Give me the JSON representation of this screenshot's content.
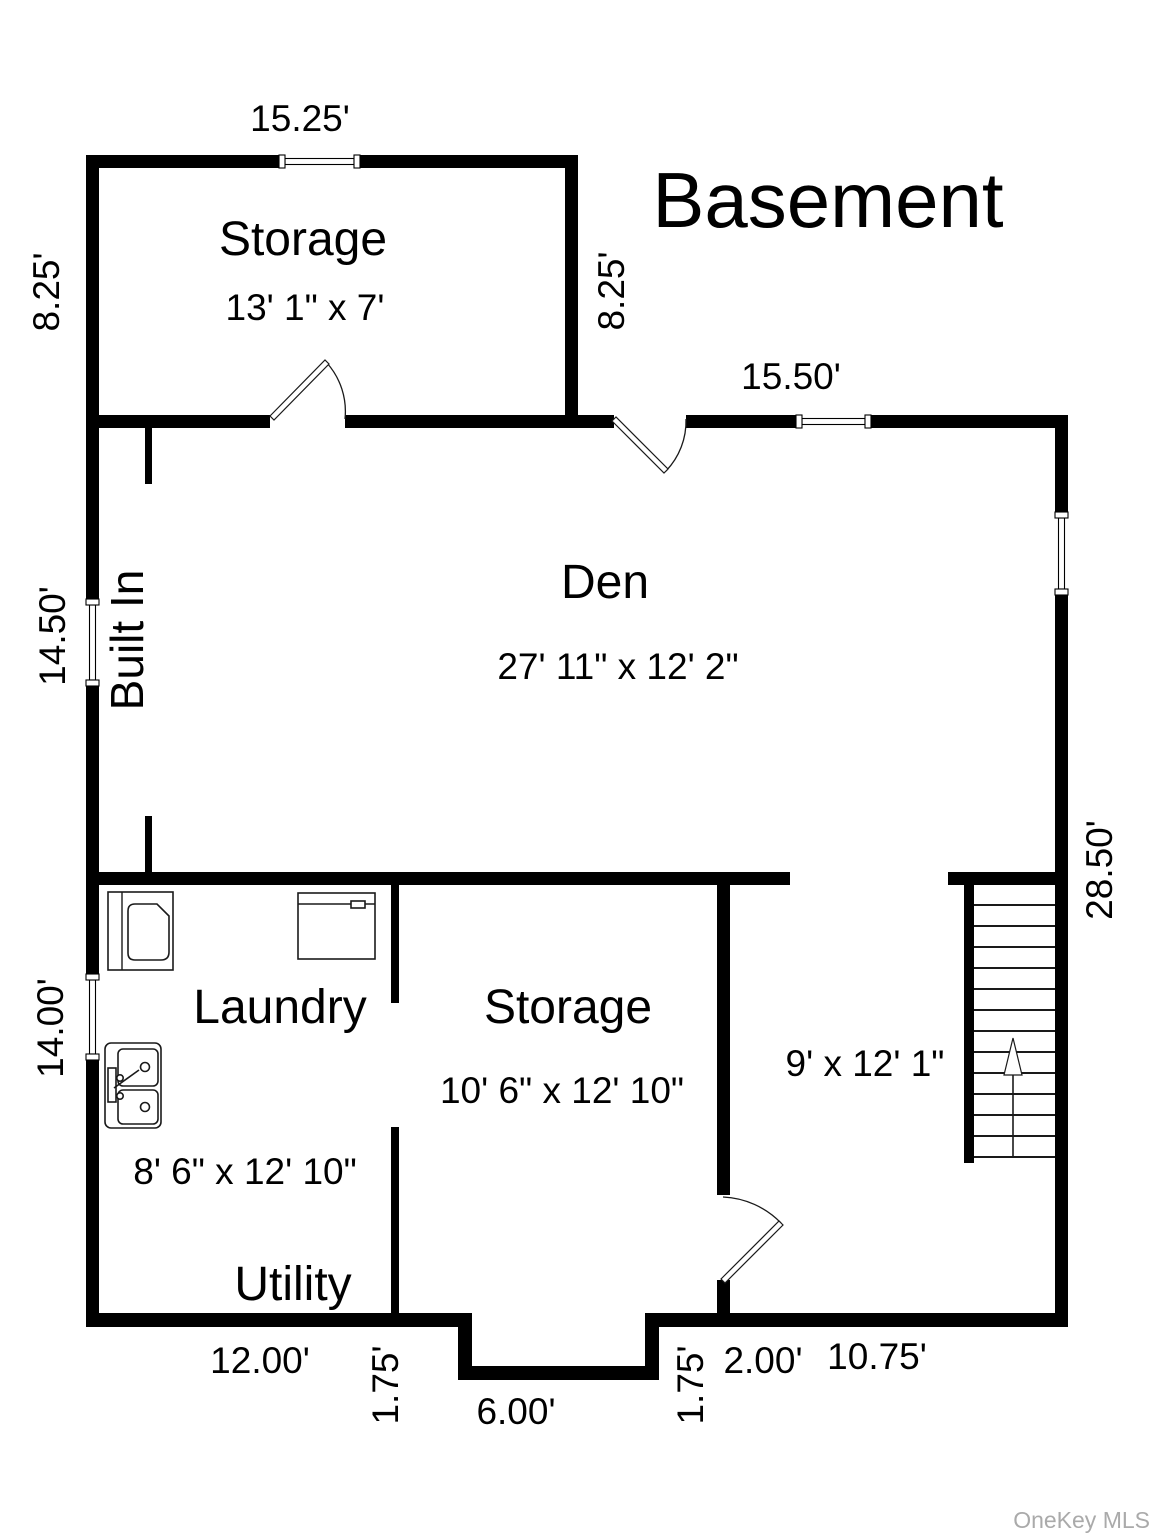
{
  "title": "Basement",
  "watermark": "OneKey MLS",
  "rooms": {
    "storage_top": {
      "label": "Storage",
      "size": "13' 1\" x 7'"
    },
    "den": {
      "label": "Den",
      "size": "27' 11\" x 12' 2\""
    },
    "laundry": {
      "label": "Laundry",
      "size": "8' 6\" x 12' 10\""
    },
    "utility": {
      "label": "Utility"
    },
    "storage_bottom": {
      "label": "Storage",
      "size": "10' 6\" x 12' 10\""
    },
    "stairwell": {
      "size": "9' x 12' 1\""
    }
  },
  "annotations": {
    "built_in": "Built In"
  },
  "dims": {
    "storage_width": "15.25'",
    "storage_height_left": "8.25'",
    "storage_height_right": "8.25'",
    "den_top": "15.50'",
    "den_left": "14.50'",
    "right_height": "28.50'",
    "laundry_height": "14.00'",
    "bottom_12": "12.00'",
    "alcove_down": "1.75'",
    "alcove_width": "6.00'",
    "alcove_up": "1.75'",
    "bottom_2": "2.00'",
    "bottom_1075": "10.75'"
  },
  "colors": {
    "wall": "#000000",
    "watermark": "#aaaaaa"
  }
}
